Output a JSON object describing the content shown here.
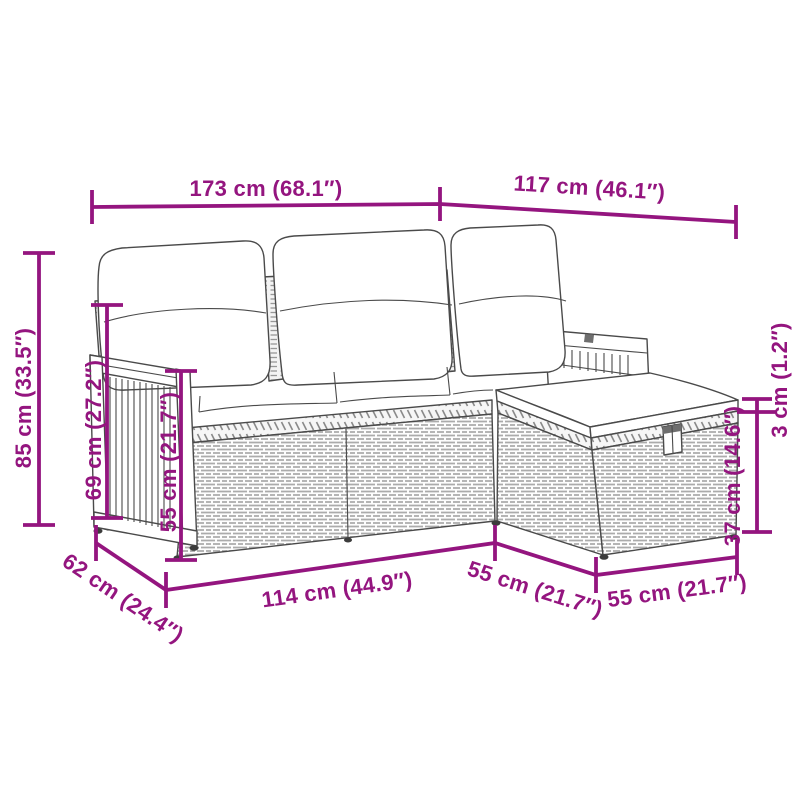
{
  "colors": {
    "accent": "#94157F",
    "line_art": "#4a4a4a",
    "background": "#ffffff"
  },
  "dims": {
    "sofa_width": "173 cm (68.1″)",
    "chaise_span": "117 cm (46.1″)",
    "total_height": "85 cm (33.5″)",
    "back_height": "69 cm (27.2″)",
    "arm_height": "55 cm (21.7″)",
    "cushion_thickness": "3 cm (1.2″)",
    "stool_height": "37 cm (14.6″)",
    "sofa_depth": "62 cm (24.4″)",
    "seat_front_width": "114 cm (44.9″)",
    "stool_gap_depth": "55 cm (21.7″)",
    "stool_width": "55 cm (21.7″)"
  }
}
